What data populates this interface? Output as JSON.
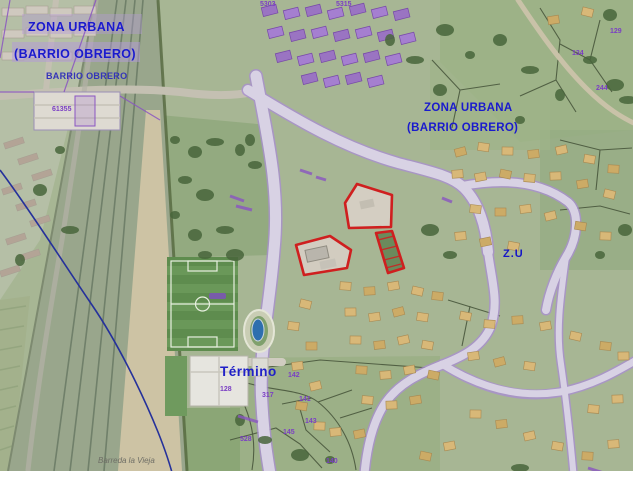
{
  "map": {
    "kind": "aerial-orthophoto-with-cadastral-overlay",
    "features": {
      "railway_corridor": "railway-corridor",
      "soccer_field": "soccer-field",
      "running_track": "running-track-with-pool",
      "red_plot_outlines": "selected-parcels-red-outline",
      "municipal_boundary": "blue-boundary-line"
    }
  },
  "labels": {
    "zona_urbana_tl_line1": "ZONA URBANA",
    "zona_urbana_tl_line2": "(BARRIO OBRERO)",
    "barrio_obrero_small": "BARRIO OBRERO",
    "zona_urbana_right_line1": "ZONA URBANA",
    "zona_urbana_right_line2": "(BARRIO OBRERO)",
    "zu": "Z.U",
    "termino": "Término",
    "barreda_la_vieja": "Barreda la Vieja"
  },
  "parcel_numbers": [
    {
      "text": "61355"
    },
    {
      "text": "128"
    },
    {
      "text": "142"
    },
    {
      "text": "317"
    },
    {
      "text": "141"
    },
    {
      "text": "143"
    },
    {
      "text": "145"
    },
    {
      "text": "528"
    },
    {
      "text": "140"
    },
    {
      "text": "129"
    },
    {
      "text": "134"
    },
    {
      "text": "244"
    },
    {
      "text": "5303"
    },
    {
      "text": "5315"
    }
  ],
  "colors": {
    "zone_label_blue": "#1a1acd",
    "cadastral_purple": "#7b3fc4",
    "plot_outline_red": "#cf1f1f",
    "boundary_line_blue": "#25319b"
  }
}
